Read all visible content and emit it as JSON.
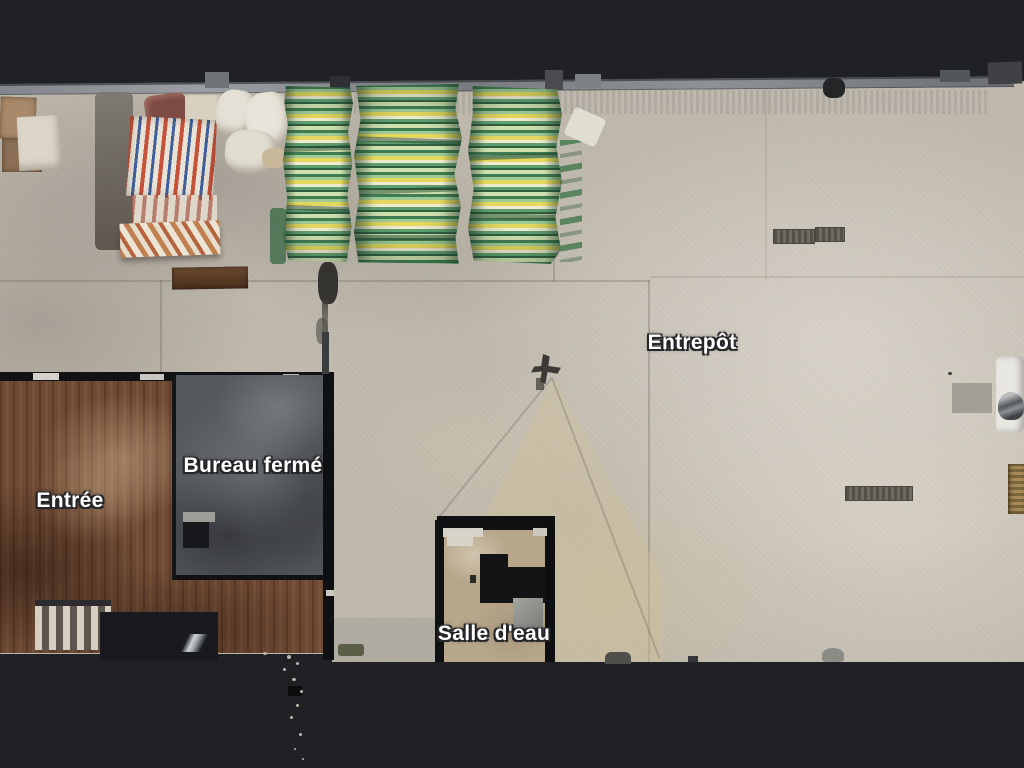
{
  "scene": {
    "view": "top-down floorplan",
    "labels": [
      {
        "id": "entrepot",
        "text": "Entrepôt"
      },
      {
        "id": "bureau-ferme",
        "text": "Bureau fermé"
      },
      {
        "id": "entree",
        "text": "Entrée"
      },
      {
        "id": "salle-deau",
        "text": "Salle d'eau"
      }
    ],
    "colors": {
      "background": "#202125",
      "concrete_floor": "#bfb9ad",
      "concrete_light": "#d3cdc1",
      "wood_floor": "#6f4a33",
      "office_floor": "#55585c",
      "bathroom_floor": "#b7a68a",
      "wall_dark": "#101113",
      "wall_top_strip": "#8a8e92",
      "label_text": "#ffffff",
      "stripe_green_dark": "#2f5e41",
      "stripe_green": "#3f7c52",
      "stripe_yellow": "#e4d75e",
      "stripe_pale": "#eee9cf",
      "fabric_red": "#c7523a",
      "fabric_blue": "#41609a",
      "fabric_white": "#e9e3d7"
    }
  }
}
